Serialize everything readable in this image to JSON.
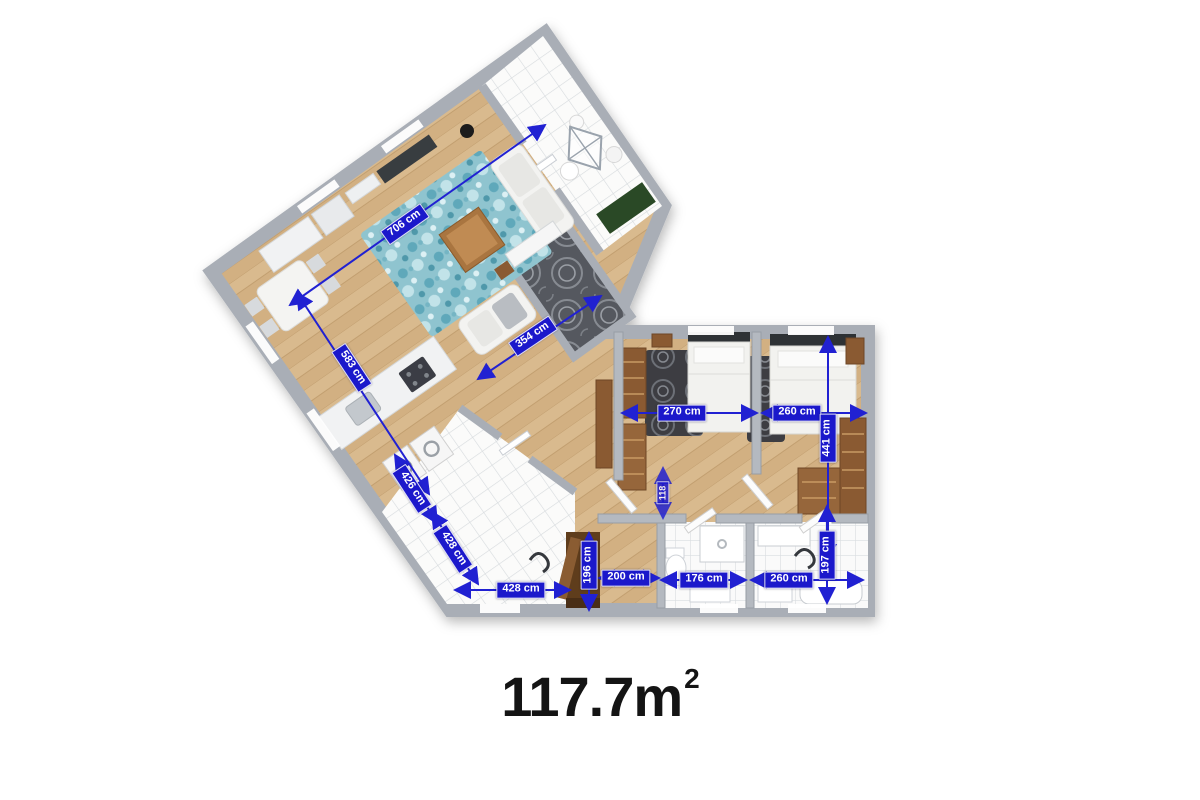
{
  "floor_plan": {
    "total_area": {
      "value": "117.7m",
      "superscript": "2"
    },
    "unit": "cm",
    "dimensions": [
      {
        "id": "living-room-length",
        "text": "706 cm"
      },
      {
        "id": "living-wing-side",
        "text": "583 cm"
      },
      {
        "id": "inner-bath-diagonal",
        "text": "354 cm"
      },
      {
        "id": "bedroom-1-width",
        "text": "270 cm"
      },
      {
        "id": "bedroom-2-width",
        "text": "260 cm"
      },
      {
        "id": "bedroom-2-depth",
        "text": "441 cm"
      },
      {
        "id": "corridor-width",
        "text": "118"
      },
      {
        "id": "entry-hall-side-a",
        "text": "426 cm"
      },
      {
        "id": "entry-hall-side-b",
        "text": "428 cm"
      },
      {
        "id": "entry-bottom-wall",
        "text": "428 cm"
      },
      {
        "id": "entry-door-depth",
        "text": "196 cm"
      },
      {
        "id": "hallway-width",
        "text": "200 cm"
      },
      {
        "id": "bathroom-1-width",
        "text": "176 cm"
      },
      {
        "id": "bathroom-2-width",
        "text": "260 cm"
      },
      {
        "id": "bathroom-2-depth",
        "text": "197 cm"
      }
    ],
    "colors": {
      "dimension_blue": "#1b18cb",
      "wood_floor": "#d9ba8e",
      "wall_gray": "#a9aeb6",
      "tile_white": "#fbfbfa",
      "living_rug_teal": "#8fc4cf",
      "furniture_brown": "#8a5a32",
      "mat_green": "#2c4a26",
      "area_text": "#141414"
    }
  }
}
